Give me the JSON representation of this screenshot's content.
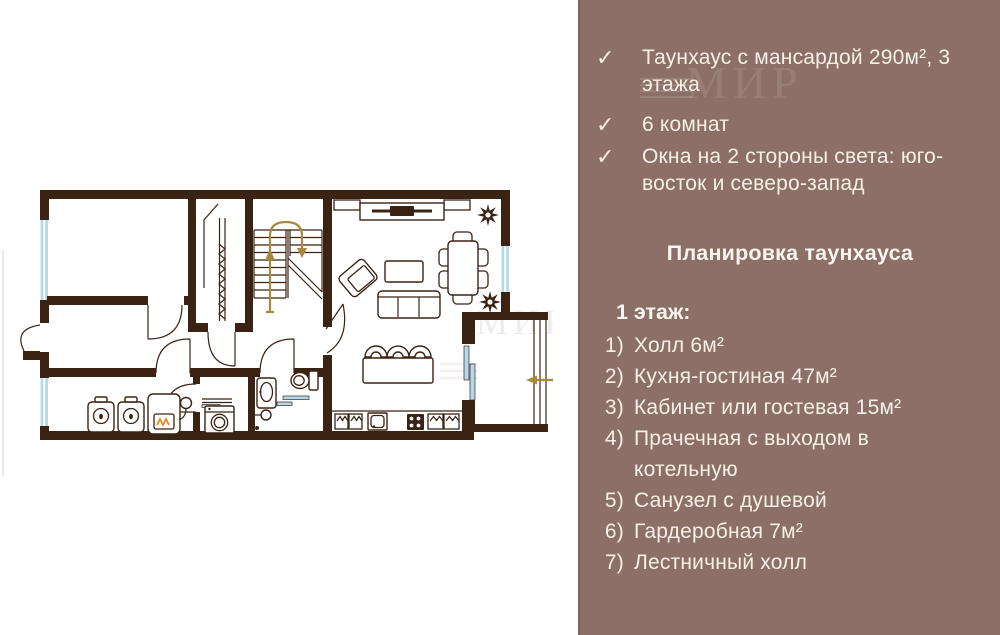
{
  "panel": {
    "background": "#8C7067",
    "text_color": "#F6EFE7",
    "checkmark": "✓",
    "features": [
      {
        "text": "Таунхаус с мансардой 290м², 3 этажа"
      },
      {
        "text": "6 комнат"
      },
      {
        "text": "Окна на 2 стороны света: юго-восток и северо-запад"
      }
    ],
    "heading": "Планировка таунхауса",
    "floor_label": "1 этаж:",
    "rooms": [
      {
        "num": "1)",
        "label": "Холл 6м²"
      },
      {
        "num": "2)",
        "label": "Кухня-гостиная 47м²"
      },
      {
        "num": "3)",
        "label": "Кабинет или гостевая 15м²"
      },
      {
        "num": "4)",
        "label": "Прачечная с выходом в котельную"
      },
      {
        "num": "5)",
        "label": "Санузел с душевой"
      },
      {
        "num": "6)",
        "label": "Гардеробная 7м²"
      },
      {
        "num": "7)",
        "label": "Лестничный холл"
      }
    ]
  },
  "floorplan": {
    "watermark": "МИР",
    "wall_color": "#3B2314",
    "window_color": "#B5D8EA",
    "arrow_color": "#A8893E",
    "flame_color": "#E8891B",
    "entry_direction": "left"
  }
}
